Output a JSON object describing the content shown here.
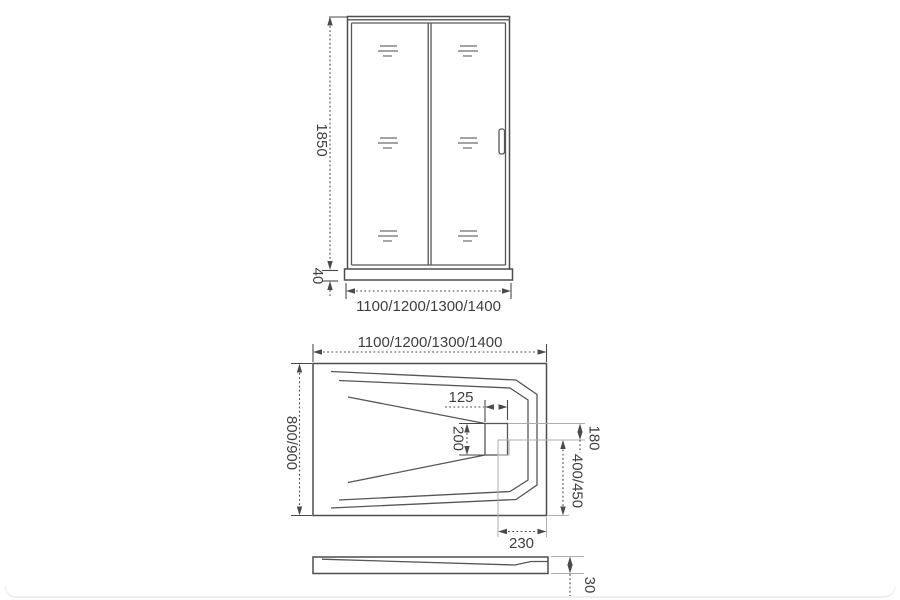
{
  "drawing": {
    "title": "shower-enclosure-technical-drawing",
    "door_front_view": {
      "height_label": "1850",
      "base_height_label": "40",
      "width_label": "1100/1200/1300/1400"
    },
    "tray_top_view": {
      "width_label": "1100/1200/1300/1400",
      "depth_label": "800/900",
      "drain_width_label": "125",
      "drain_length_label": "200",
      "drain_side_offset_label": "180",
      "drain_back_offset_label": "400/450",
      "drain_corner_offset_label": "230"
    },
    "tray_side_view": {
      "height_label": "30"
    },
    "colors": {
      "background": "#ffffff",
      "line": "#4d4d4d",
      "dimension": "#4a4a4a",
      "extension": "#abaeb1",
      "text": "#3f3f3f"
    }
  }
}
